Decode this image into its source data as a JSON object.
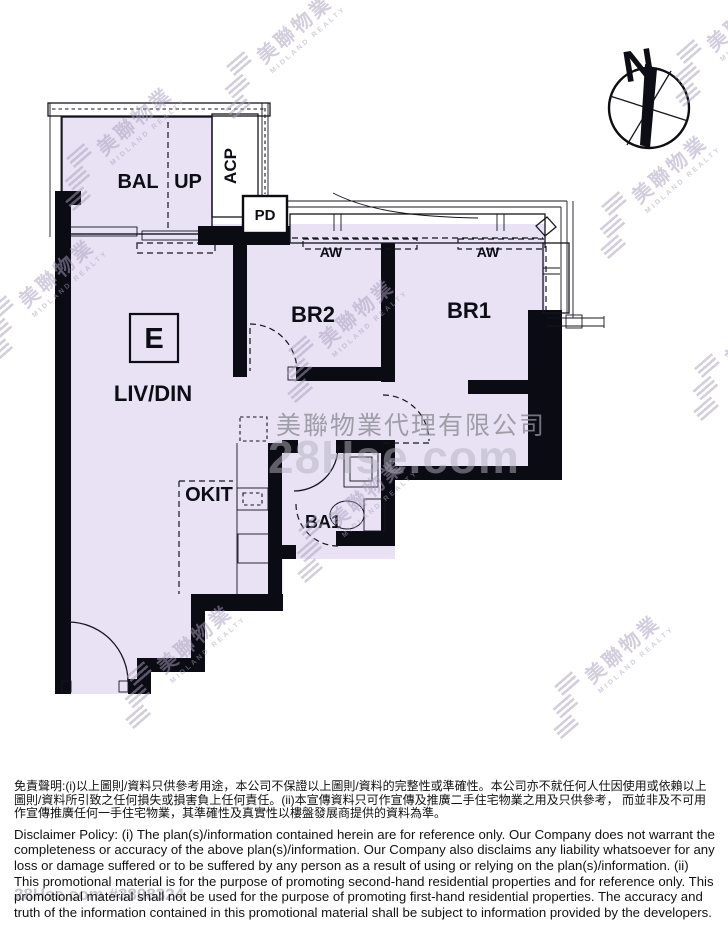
{
  "plan": {
    "labels": {
      "bal": "BAL",
      "up": "UP",
      "acp": "ACP",
      "pd": "PD",
      "aw": "AW",
      "br2": "BR2",
      "br1": "BR1",
      "unit_mark": "E",
      "liv_din": "LIV/DIN",
      "okit": "OKIT",
      "ba1": "BA1"
    }
  },
  "compass": {
    "north_label": "N"
  },
  "watermark": {
    "brand_cn": "美聯物業",
    "brand_en": "MIDLAND REALTY",
    "company_full": "美聯物業代理有限公司",
    "site": "28Hse.com",
    "site_id": "28Hse.com #3898324"
  },
  "disclaimer": {
    "zh": "免責聲明:(i)以上圖則/資料只供參考用途，本公司不保證以上圖則/資料的完整性或準確性。本公司亦不就任何人仕因使用或依賴以上圖則/資料所引致之任何損失或損害負上任何責任。(ii)本宣傳資料只可作宣傳及推廣二手住宅物業之用及只供參考， 而並非及不可用作宣傳推廣任何一手住宅物業，其準確性及真實性以樓盤發展商提供的資料為準。",
    "en": "Disclaimer Policy: (i) The plan(s)/information contained herein are for reference only. Our Company does not warrant the completeness or accuracy of the above plan(s)/information. Our Company also disclaims any liability whatsoever for any loss or damage suffered or to be suffered by any person as a result of using or relying on the plan(s)/information. (ii) This promotional material is for the purpose of promoting second-hand residential properties and for reference only. This promotional material shall not be used for the purpose of promoting first-hand residential properties. The accuracy and truth of the information contained in this promotional material shall be subject to information provided by the developers."
  },
  "colors": {
    "room_fill": "#e9e2f4",
    "wall": "#0b0b13",
    "watermark": "#a89fbc"
  }
}
